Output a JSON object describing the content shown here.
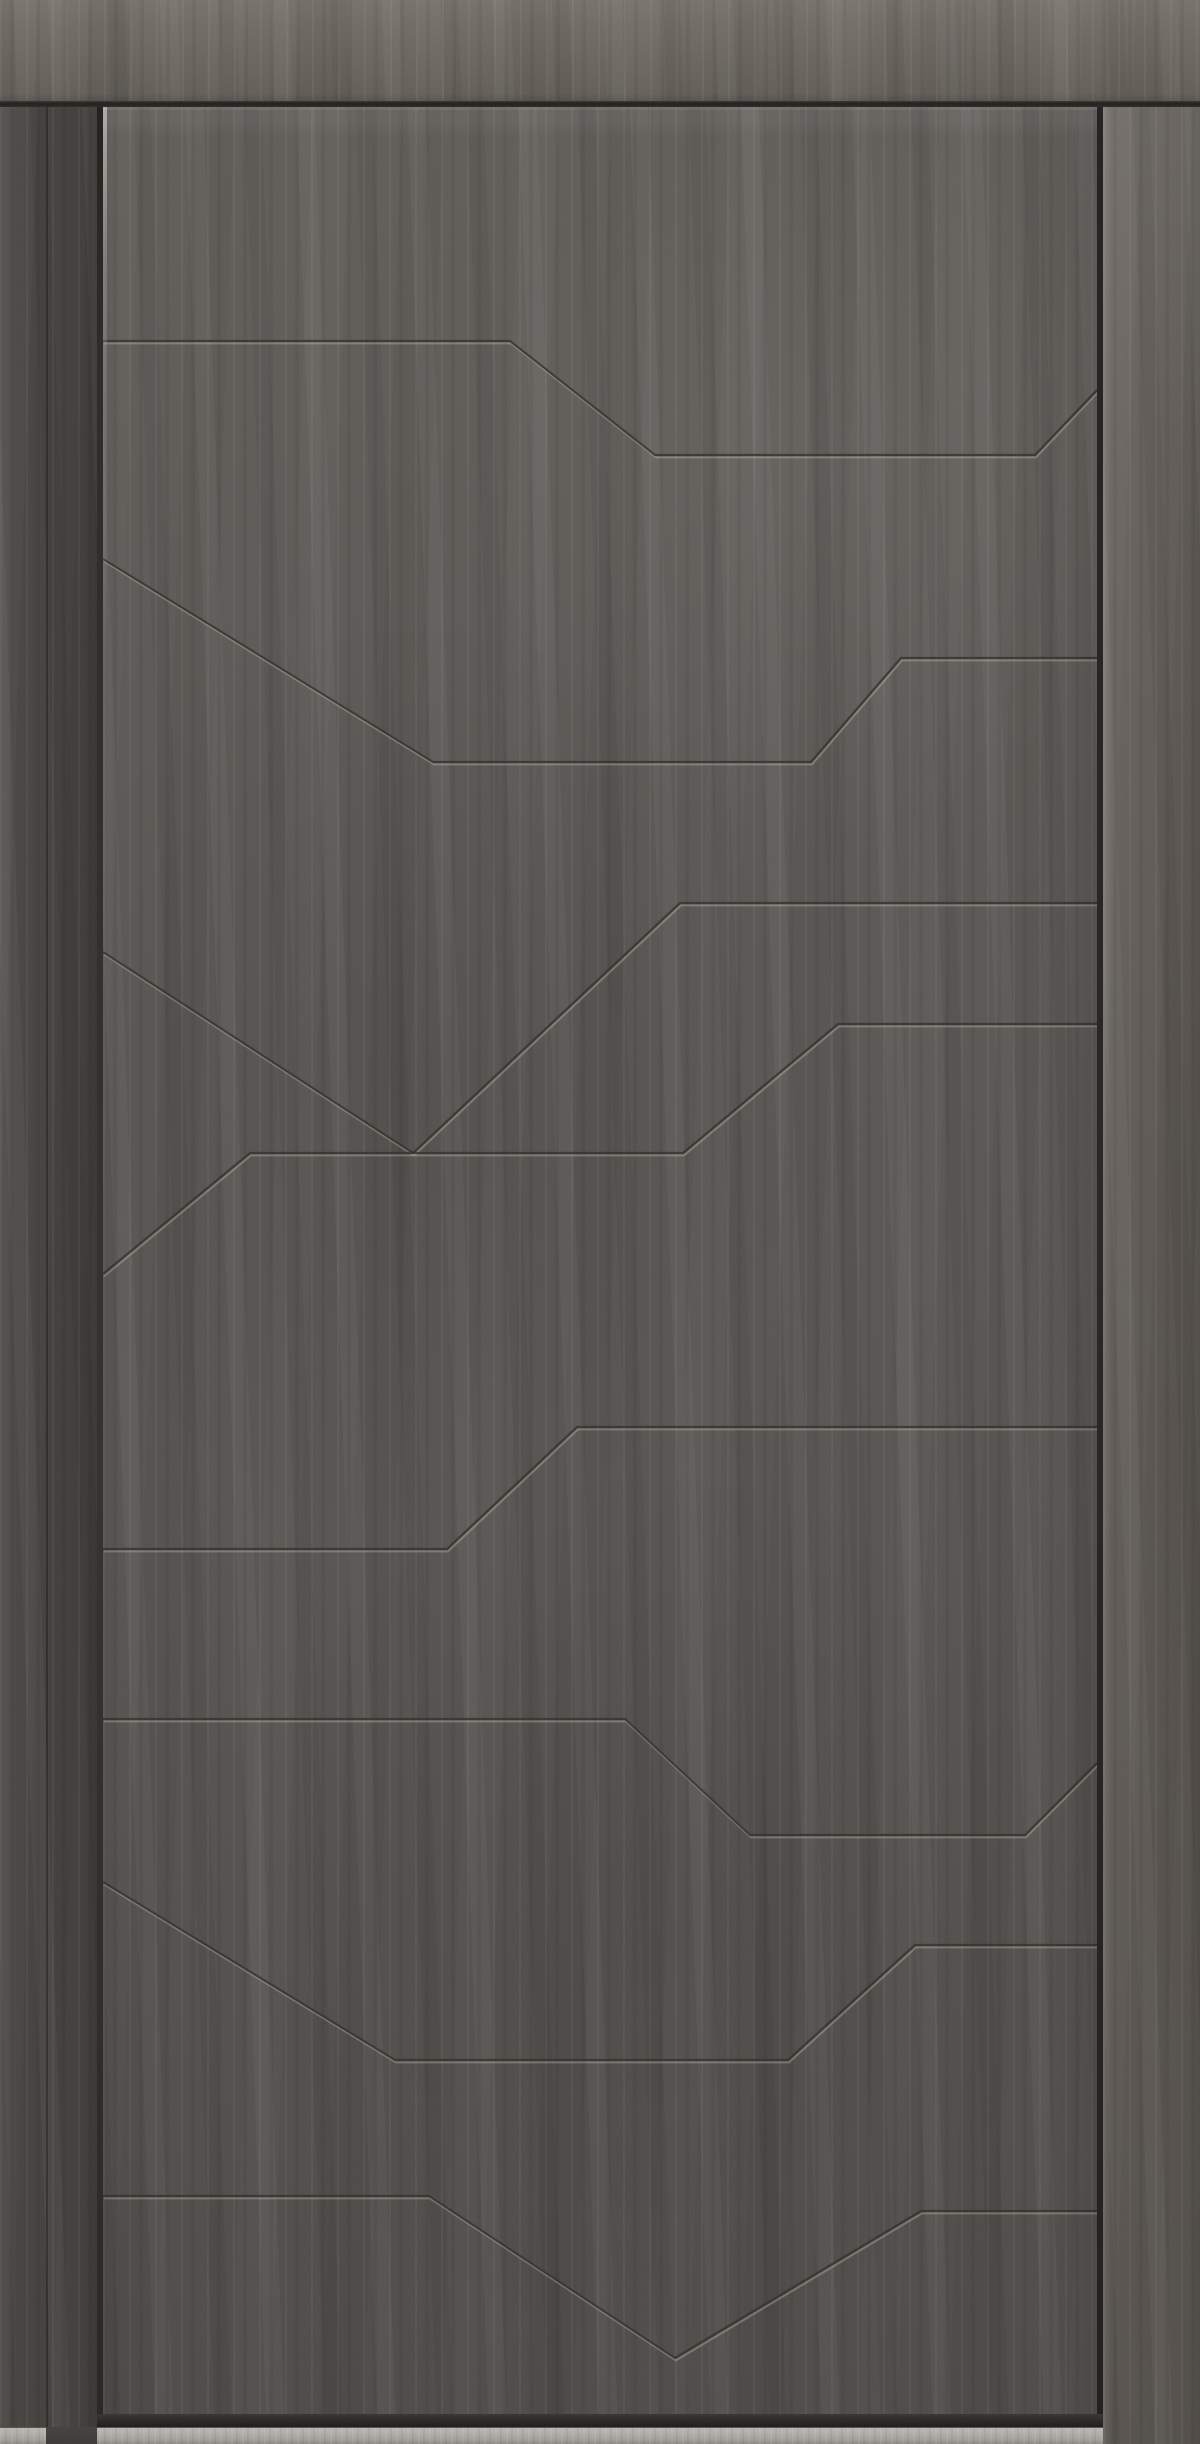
{
  "scene": {
    "subject": "Modern entrance door with dark graphite concrete-style finish, closed, viewed straight on; angular engraved groove pattern, wood-grain frame and light aluminum sill",
    "width_px": 1200,
    "height_px": 2444
  },
  "palette": {
    "header_band": "#6f6a63",
    "jamb_left": "#4a4643",
    "stile_right": "#645f5a",
    "leaf_top_c": "#615e5a",
    "leaf_mid": "#5b5855",
    "leaf_bottom": "#4f4c49",
    "seam_dark": "#232120",
    "gap_dark": "#2b2927",
    "groove_dark": "#34312e",
    "groove_highlight": "#cfc8bc",
    "edge_highlight": "#b5b0a7",
    "sill_light": "#b7b4af",
    "sill_mid": "#a3a09b",
    "sill_dark": "#8d8a85",
    "foot_dark": "#3e3b38",
    "shadow_gap": "#2e2c29"
  },
  "frame": {
    "header_height": 101,
    "seam_top": 101,
    "seam_height": 6,
    "jamb_left_width": 97,
    "casing_seam_x": 46,
    "leaf_left": 103,
    "leaf_top": 107,
    "leaf_width": 994,
    "leaf_height": 2307,
    "gap_width": 6,
    "stile_right_x": 1103,
    "sill_top": 2427,
    "sill_height": 17
  },
  "grooves": {
    "style": {
      "dark_width": 2.2,
      "highlight_width": 2,
      "highlight_dx": 1,
      "highlight_dy": 2.4,
      "dark_opacity": 0.8,
      "highlight_opacity": 0.32
    },
    "lines": [
      {
        "id": "groove-1",
        "points": [
          [
            0,
            234
          ],
          [
            407,
            234
          ],
          [
            552,
            348
          ],
          [
            932,
            348
          ],
          [
            994,
            283
          ]
        ]
      },
      {
        "id": "groove-2",
        "points": [
          [
            0,
            452
          ],
          [
            330,
            655
          ],
          [
            708,
            655
          ],
          [
            798,
            551
          ],
          [
            994,
            551
          ]
        ]
      },
      {
        "id": "groove-3",
        "points": [
          [
            0,
            845
          ],
          [
            310,
            1046
          ]
        ]
      },
      {
        "id": "groove-4",
        "points": [
          [
            994,
            796
          ],
          [
            577,
            796
          ],
          [
            310,
            1046
          ]
        ]
      },
      {
        "id": "groove-5",
        "points": [
          [
            0,
            1167
          ],
          [
            147,
            1046
          ],
          [
            580,
            1046
          ],
          [
            735,
            917
          ],
          [
            994,
            917
          ]
        ]
      },
      {
        "id": "groove-6",
        "points": [
          [
            0,
            1442
          ],
          [
            344,
            1442
          ],
          [
            474,
            1320
          ],
          [
            994,
            1320
          ]
        ]
      },
      {
        "id": "groove-7",
        "points": [
          [
            0,
            1612
          ],
          [
            522,
            1612
          ],
          [
            647,
            1728
          ],
          [
            922,
            1728
          ],
          [
            994,
            1656
          ]
        ]
      },
      {
        "id": "groove-8",
        "points": [
          [
            0,
            1775
          ],
          [
            292,
            1953
          ],
          [
            685,
            1953
          ],
          [
            812,
            1838
          ],
          [
            994,
            1838
          ]
        ]
      },
      {
        "id": "groove-9",
        "points": [
          [
            0,
            2089
          ],
          [
            326,
            2089
          ],
          [
            572,
            2251
          ],
          [
            818,
            2104
          ],
          [
            994,
            2104
          ]
        ]
      }
    ]
  }
}
